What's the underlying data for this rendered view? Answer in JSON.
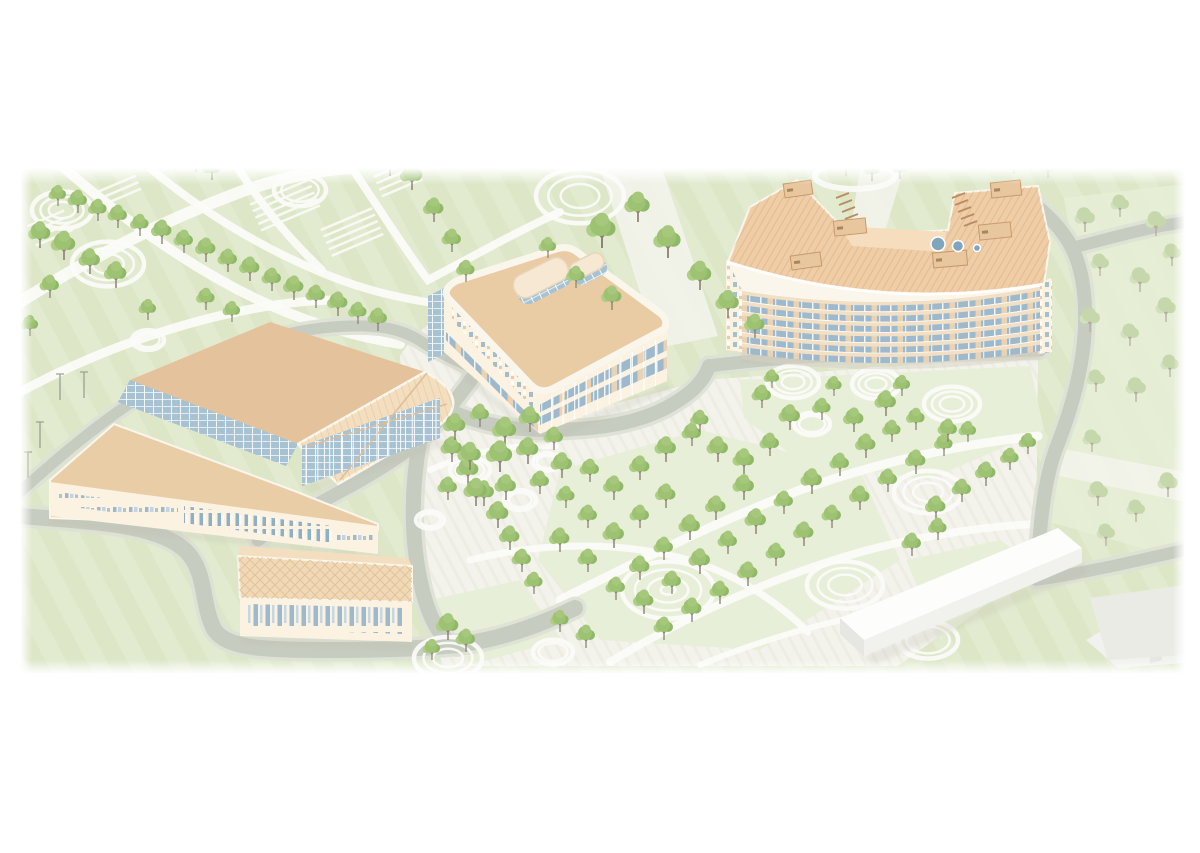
{
  "palette": {
    "green": "#e2ebd0",
    "green2": "#dde7c8",
    "lawn": "#e8efd9",
    "plaza": "#f3f3ec",
    "plazaLine": "#e6e6dd",
    "path": "#fbfbf8",
    "road": "#c7ccc0",
    "roadEdge": "#dde1d5",
    "wall": "#fbf2e2",
    "parapet": "#faf6ec",
    "roofDark": "#e4c29b",
    "roofLight": "#f3debf",
    "roofWing": "#e9cda7",
    "roofHall": "#f2d9b6",
    "roofMid": "#e9cba4",
    "roofCurved": "#efcda7",
    "spandrel": "#f3e0c4",
    "glass": "#a7c2d3",
    "glass2": "#9db9cb",
    "hatch": "#dcbd96",
    "hatch2": "#d8ab7c",
    "tree1": "#9cc272",
    "tree2": "#aecd85",
    "tree3": "#8fb868",
    "tree4": "#a6c87c",
    "treeF1": "#c6d7ab",
    "treeF2": "#d3e0bc",
    "trunk": "#8a8273",
    "trunkF": "#b3ae9e",
    "white1": "#fdfdfc",
    "white2": "#f1f1ee",
    "white3": "#e6e6e2",
    "plaza2": "#ebebe6",
    "shadow": "#b9b4a6",
    "vent": "#7fa6bd",
    "boxFill": "#e8c79e",
    "boxLine": "#c9996b"
  },
  "scene": {
    "x": 20,
    "y": 168,
    "width": 1165,
    "height": 506
  },
  "ground": {
    "plaza": "M 400,356 C 412,336 430,320 452,312 L 470,308 L 540,424 L 704,380 L 1038,356 L 1036,566 L 898,666 L 442,666 L 416,556 Z",
    "lawns": [
      "560,470 700,430 860,470 900,560 760,650 600,640 538,560",
      "740,380 1030,366 1044,430 928,480 798,460 744,418",
      "430,600 520,580 562,640 470,665",
      "906,560 1000,540 1036,566 940,640"
    ],
    "meadow": "1064,198 1185,184 1185,560 1042,520 1058,430 1086,330",
    "pale_bands": [
      "600,168 662,168 718,336 658,348",
      "860,168 904,168 886,228 850,234",
      "1048,446 1185,472 1185,502 1040,472"
    ],
    "white_paths": [
      {
        "d": "M 20,302 C 90,258 160,222 240,192 C 280,178 320,170 350,168",
        "w": 12
      },
      {
        "d": "M 64,168 C 110,208 160,246 220,280 C 280,314 340,334 400,344",
        "w": 10
      },
      {
        "d": "M 150,168 C 200,210 260,248 330,276 C 370,292 410,300 440,304",
        "w": 8
      },
      {
        "d": "M 20,392 C 80,360 140,336 210,318 C 260,306 300,300 340,300",
        "w": 9
      },
      {
        "d": "M 352,168 C 380,210 404,248 428,280 C 470,258 520,230 560,212",
        "w": 8
      },
      {
        "d": "M 238,168 C 262,206 290,240 322,270",
        "w": 8
      },
      {
        "d": "M 560,600 C 640,560 720,520 800,490 C 880,462 960,444 1038,436",
        "w": 9
      },
      {
        "d": "M 470,560 C 550,540 630,542 695,562 C 738,576 778,602 808,632",
        "w": 7
      },
      {
        "d": "M 610,662 C 690,614 780,574 868,550 C 930,534 990,526 1036,524",
        "w": 8
      },
      {
        "d": "M 700,665 C 760,640 830,620 900,608",
        "w": 6
      },
      {
        "d": "M 430,470 C 470,452 510,444 556,446",
        "w": 6
      }
    ],
    "rings": [
      [
        62,
        210,
        30,
        3
      ],
      [
        108,
        264,
        36,
        3
      ],
      [
        300,
        190,
        26,
        2
      ],
      [
        148,
        340,
        16,
        2
      ],
      [
        580,
        196,
        44,
        3
      ],
      [
        793,
        382,
        26,
        3
      ],
      [
        876,
        384,
        24,
        3
      ],
      [
        952,
        404,
        28,
        3
      ],
      [
        812,
        424,
        18,
        2
      ],
      [
        928,
        492,
        34,
        3
      ],
      [
        668,
        590,
        46,
        4
      ],
      [
        845,
        585,
        38,
        3
      ],
      [
        448,
        658,
        34,
        3
      ],
      [
        928,
        640,
        30,
        2
      ],
      [
        553,
        652,
        20,
        2
      ],
      [
        470,
        470,
        20,
        2
      ],
      [
        520,
        500,
        16,
        2
      ],
      [
        547,
        462,
        14,
        2
      ],
      [
        430,
        520,
        14,
        2
      ]
    ],
    "arc_behind": {
      "cx": 855,
      "cy": 176,
      "rx": 40,
      "ry": 13
    },
    "courts": [
      [
        285,
        205,
        -23,
        64,
        5
      ],
      [
        352,
        232,
        -23,
        56,
        5
      ],
      [
        50,
        228,
        -23,
        40,
        4
      ],
      [
        398,
        178,
        -23,
        44,
        4
      ],
      [
        120,
        190,
        -23,
        40,
        3
      ]
    ]
  },
  "roads": [
    {
      "d": "M 20,516 C 95,522 158,524 186,551 C 207,572 201,604 214,629 C 226,649 266,650 330,650 C 372,650 420,649 455,645 C 500,640 540,625 575,608",
      "w": 16
    },
    {
      "d": "M 420,440 C 414,472 412,505 414,535 C 416,568 424,606 436,626 C 443,638 450,644 457,646",
      "w": 15
    },
    {
      "d": "M 478,370 C 458,398 442,418 420,440",
      "w": 14
    },
    {
      "d": "M 420,440 C 400,458 370,476 336,494 C 310,508 280,524 258,540",
      "w": 13
    },
    {
      "d": "M 20,492 C 60,456 98,424 138,398 C 178,372 252,336 322,328 C 368,323 398,326 422,342 C 446,358 464,362 478,372",
      "w": 11
    },
    {
      "d": "M 436,404 C 470,422 505,430 545,430 C 595,430 642,424 676,402 C 696,390 705,378 709,366",
      "w": 14
    },
    {
      "d": "M 709,366 C 770,358 845,354 915,353 C 960,352 1005,351 1040,350",
      "w": 13
    },
    {
      "d": "M 1026,198 C 1048,214 1063,230 1072,248 C 1083,270 1086,300 1085,328 C 1083,368 1072,408 1057,446 C 1045,476 1040,520 1038,564",
      "w": 14
    },
    {
      "d": "M 1072,248 C 1102,240 1132,232 1161,226 L 1185,222",
      "w": 12
    },
    {
      "d": "M 1036,580 C 1090,572 1140,560 1193,548",
      "w": 12
    }
  ],
  "buildings": {
    "sports_complex": {
      "parts": [
        {
          "pts": "50,480 114,424 292,490 378,524 378,530 50,518",
          "fill": "roofWing",
          "stroke": "parapet",
          "sw": 2
        },
        {
          "pts": "50,482 378,526 378,554 50,516",
          "fill": "wall"
        },
        {
          "pts": "130,380 270,322 425,372 298,444",
          "fill": "roofDark"
        },
        {
          "d": "M 298,444 L 425,372 Q 450,385 453,400 Q 455,414 438,426 L 338,484 Z",
          "fill": "roofLight",
          "overlay": "hatchL",
          "stroke": "parapet",
          "sw": 2.5
        },
        {
          "pts": "130,380 298,444 286,466 118,402",
          "fill": "glass",
          "overlay": "glassGrid"
        },
        {
          "pts": "302,446 440,398 440,438 302,486",
          "fill": "glass2",
          "overlay": "glassGrid"
        },
        {
          "pts": "240,546 408,558 412,566 238,556",
          "fill": "roofLight"
        },
        {
          "pts": "238,556 412,566 412,602 240,598",
          "fill": "roofHall",
          "overlay": "xhatch",
          "stroke": "parapet",
          "sw": 2
        },
        {
          "pts": "240,598 412,602 412,642 240,636",
          "fill": "wall"
        }
      ],
      "window_bands": [
        {
          "pts": "58,492 178,508 178,521 58,505",
          "pattern": "winPairs",
          "rot": 7
        },
        {
          "pts": "184,506 332,526 332,543 184,523",
          "pattern": "winBars",
          "rot": 7
        },
        {
          "pts": "336,528 374,533 374,549 336,544",
          "pattern": "winPairs",
          "rot": 7
        },
        {
          "pts": "248,604 404,608 404,634 248,629",
          "pattern": "winBars2",
          "rot": 1
        }
      ],
      "x_lines": [
        "305,447 447,404",
        "340,480 427,373"
      ],
      "columns": {
        "x0": 306,
        "x1": 436,
        "yTop0": 445,
        "yTop1": 399,
        "h": 40,
        "n": 11
      }
    },
    "central_building": {
      "roof": {
        "d": "M 456,281 L 556,249 Q 568,245 577,252 L 660,313 Q 669,320 664,329 L 554,388 Q 541,395 531,385 L 449,299 Q 441,290 456,281 Z"
      },
      "west_glass": "428,296 444,288 444,354 428,362",
      "left_face": {
        "pts": "444,289 540,393 540,434 444,352",
        "tiles": "452,302 534,392 534,410 452,320",
        "strip": "446,332 538,424 538,432 446,340",
        "rot": 47
      },
      "right_face": {
        "tl": [
          540,
          393
        ],
        "tr": [
          667,
          323
        ],
        "bl": [
          540,
          434
        ],
        "br": [
          667,
          381
        ],
        "bands": [
          [
            0.28,
            0.47
          ],
          [
            0.58,
            0.78
          ]
        ],
        "colN": 11,
        "colF": 0.18,
        "rot": -29
      },
      "penthouses": [
        {
          "x": 544,
          "y": 284,
          "w": 58,
          "h": 24,
          "rot": -27,
          "r": 11
        },
        {
          "x": 590,
          "y": 272,
          "w": 36,
          "h": 17,
          "rot": -27,
          "r": 8
        }
      ]
    },
    "curved_building": {
      "roof": {
        "d": "M 728,262 Q 884,312 1044,284 L 1050,242 L 1038,186 L 955,193 L 948,230 L 860,236 L 838,223 L 797,180 L 750,207 Z",
        "front": "M 728,262 Q 884,312 1044,284"
      },
      "terrace": "840,226 946,232 944,252 852,246",
      "vents": [
        [
          938,
          244,
          7
        ],
        [
          958,
          246,
          5.5
        ],
        [
          977,
          248,
          3.5
        ]
      ],
      "boxes": [
        [
          798,
          189,
          28,
          14,
          -8
        ],
        [
          850,
          227,
          32,
          15,
          -6
        ],
        [
          1006,
          189,
          30,
          15,
          -6
        ],
        [
          995,
          231,
          32,
          15,
          -6
        ],
        [
          950,
          259,
          34,
          15,
          -5
        ],
        [
          806,
          261,
          30,
          14,
          -8
        ]
      ],
      "louvers": [
        {
          "x": 836,
          "y": 198,
          "n": 5
        },
        {
          "x": 952,
          "y": 198,
          "n": 5
        }
      ],
      "facade": {
        "x0": 742,
        "x1": 1040,
        "top": [
          290,
          314,
          286
        ],
        "bot": [
          353,
          374,
          351
        ],
        "floors": 6,
        "spandrel": 0.42
      },
      "gables": [
        "726,260 744,255 744,352 726,350",
        "1038,284 1052,277 1052,352 1038,354"
      ],
      "west_face": "728,262 750,207 758,211 742,263"
    },
    "context_blocks": [
      {
        "pts": "840,618 1058,528 1082,548 864,640",
        "fill": "white1"
      },
      {
        "pts": "864,640 1082,548 1082,563 864,656",
        "fill": "white2"
      },
      {
        "pts": "840,618 864,640 864,656 840,634",
        "fill": "white3"
      },
      {
        "pts": "1086,640 1150,602 1196,612 1196,662 1118,668",
        "fill": "white2"
      },
      {
        "pts": "1150,602 1162,606 1162,660 1150,664",
        "fill": "white3"
      },
      {
        "pts": "1090,598 1185,585 1185,655 1108,660",
        "fill": "plaza2"
      }
    ]
  },
  "shadows": [
    "50,516 378,552 378,560 50,524",
    "240,636 412,642 412,650 242,644",
    "302,486 440,438 448,444 310,494",
    "446,354 540,436 667,383 672,390 540,446 444,362",
    "742,352 1040,350 1040,360 742,362",
    "864,656 1082,563 1090,572 872,666"
  ],
  "light_poles": [
    [
      60,
      400
    ],
    [
      84,
      398
    ],
    [
      40,
      448
    ],
    [
      28,
      478
    ]
  ],
  "trees_main": [
    [
      58,
      206,
      0.9
    ],
    [
      78,
      213,
      1
    ],
    [
      98,
      221,
      0.95
    ],
    [
      118,
      228,
      1
    ],
    [
      140,
      236,
      0.95
    ],
    [
      162,
      244,
      1.05
    ],
    [
      184,
      253,
      1
    ],
    [
      206,
      262,
      1.05
    ],
    [
      228,
      272,
      1
    ],
    [
      250,
      281,
      1.05
    ],
    [
      272,
      291,
      1
    ],
    [
      294,
      300,
      1.05
    ],
    [
      316,
      308,
      1
    ],
    [
      338,
      316,
      1.05
    ],
    [
      358,
      324,
      0.95
    ],
    [
      378,
      331,
      1
    ],
    [
      40,
      248,
      1.15
    ],
    [
      64,
      260,
      1.25
    ],
    [
      90,
      274,
      1.1
    ],
    [
      116,
      288,
      1.15
    ],
    [
      50,
      298,
      1
    ],
    [
      206,
      310,
      0.95
    ],
    [
      232,
      322,
      0.9
    ],
    [
      30,
      336,
      0.9
    ],
    [
      148,
      320,
      0.9
    ],
    [
      196,
      172,
      1
    ],
    [
      212,
      180,
      0.9
    ],
    [
      390,
      176,
      1.1
    ],
    [
      412,
      190,
      1.15
    ],
    [
      434,
      222,
      1.05
    ],
    [
      452,
      252,
      1
    ],
    [
      466,
      282,
      0.95
    ],
    [
      602,
      248,
      1.5
    ],
    [
      638,
      222,
      1.3
    ],
    [
      668,
      258,
      1.4
    ],
    [
      700,
      290,
      1.25
    ],
    [
      728,
      318,
      1.2
    ],
    [
      755,
      338,
      1.05
    ],
    [
      612,
      310,
      1.05
    ],
    [
      576,
      288,
      0.95
    ],
    [
      548,
      258,
      0.9
    ],
    [
      452,
      462,
      1.1
    ],
    [
      468,
      484,
      1.15
    ],
    [
      484,
      506,
      1.1
    ],
    [
      498,
      528,
      1.15
    ],
    [
      510,
      550,
      1.05
    ],
    [
      522,
      572,
      1
    ],
    [
      534,
      594,
      0.95
    ],
    [
      455,
      440,
      1.15
    ],
    [
      480,
      427,
      1
    ],
    [
      505,
      446,
      1.25
    ],
    [
      530,
      432,
      1.1
    ],
    [
      470,
      470,
      1.2
    ],
    [
      500,
      472,
      1.35
    ],
    [
      528,
      464,
      1.15
    ],
    [
      554,
      450,
      1
    ],
    [
      562,
      478,
      1.1
    ],
    [
      448,
      500,
      1
    ],
    [
      476,
      506,
      1.2
    ],
    [
      506,
      500,
      1.1
    ],
    [
      540,
      494,
      1
    ],
    [
      566,
      508,
      0.95
    ],
    [
      590,
      482,
      1
    ],
    [
      614,
      500,
      1.05
    ],
    [
      588,
      528,
      1
    ],
    [
      560,
      552,
      1.05
    ],
    [
      588,
      572,
      1
    ],
    [
      614,
      548,
      1.1
    ],
    [
      640,
      528,
      1
    ],
    [
      666,
      508,
      1.05
    ],
    [
      640,
      480,
      1.05
    ],
    [
      666,
      462,
      1.1
    ],
    [
      692,
      446,
      1
    ],
    [
      718,
      462,
      1.1
    ],
    [
      700,
      432,
      0.95
    ],
    [
      744,
      474,
      1.1
    ],
    [
      770,
      456,
      1
    ],
    [
      744,
      500,
      1.1
    ],
    [
      716,
      520,
      1.05
    ],
    [
      690,
      540,
      1.1
    ],
    [
      664,
      560,
      1
    ],
    [
      640,
      580,
      1.05
    ],
    [
      616,
      600,
      1
    ],
    [
      644,
      614,
      1.05
    ],
    [
      672,
      594,
      1
    ],
    [
      700,
      574,
      1.1
    ],
    [
      728,
      554,
      1
    ],
    [
      756,
      534,
      1.1
    ],
    [
      784,
      514,
      1
    ],
    [
      812,
      494,
      1.1
    ],
    [
      840,
      476,
      1
    ],
    [
      866,
      458,
      1.05
    ],
    [
      892,
      442,
      0.95
    ],
    [
      664,
      640,
      1
    ],
    [
      692,
      622,
      1.05
    ],
    [
      720,
      604,
      1
    ],
    [
      748,
      586,
      1.05
    ],
    [
      776,
      566,
      1
    ],
    [
      804,
      546,
      1.05
    ],
    [
      832,
      528,
      1
    ],
    [
      860,
      510,
      1.05
    ],
    [
      888,
      492,
      1
    ],
    [
      916,
      474,
      1.05
    ],
    [
      944,
      456,
      0.95
    ],
    [
      968,
      442,
      0.9
    ],
    [
      936,
      520,
      1.05
    ],
    [
      962,
      502,
      1
    ],
    [
      986,
      486,
      1.05
    ],
    [
      1010,
      470,
      0.95
    ],
    [
      1028,
      454,
      0.9
    ],
    [
      912,
      556,
      1
    ],
    [
      938,
      540,
      0.95
    ],
    [
      762,
      408,
      1
    ],
    [
      790,
      430,
      1.1
    ],
    [
      822,
      420,
      0.95
    ],
    [
      854,
      432,
      1.05
    ],
    [
      886,
      416,
      1.1
    ],
    [
      916,
      430,
      0.95
    ],
    [
      948,
      442,
      1
    ],
    [
      902,
      396,
      0.9
    ],
    [
      834,
      396,
      0.85
    ],
    [
      772,
      388,
      0.8
    ],
    [
      448,
      640,
      1.15
    ],
    [
      466,
      652,
      1
    ],
    [
      432,
      660,
      0.9
    ],
    [
      586,
      648,
      1
    ],
    [
      560,
      632,
      0.95
    ]
  ],
  "trees_faint": [
    [
      1085,
      232,
      1.1
    ],
    [
      1120,
      217,
      1
    ],
    [
      1156,
      236,
      1.1
    ],
    [
      1100,
      276,
      1
    ],
    [
      1140,
      292,
      1.1
    ],
    [
      1172,
      266,
      1
    ],
    [
      1090,
      332,
      1.1
    ],
    [
      1130,
      346,
      1
    ],
    [
      1166,
      322,
      1.1
    ],
    [
      1096,
      392,
      1
    ],
    [
      1136,
      402,
      1.1
    ],
    [
      1170,
      377,
      1
    ],
    [
      1092,
      452,
      1
    ],
    [
      1098,
      506,
      1.1
    ],
    [
      1136,
      522,
      1
    ],
    [
      1168,
      497,
      1.1
    ],
    [
      1106,
      546,
      1
    ],
    [
      846,
      176,
      1
    ],
    [
      872,
      181,
      0.9
    ],
    [
      900,
      179,
      0.85
    ],
    [
      1014,
      174,
      0.85
    ],
    [
      1048,
      178,
      0.8
    ]
  ]
}
